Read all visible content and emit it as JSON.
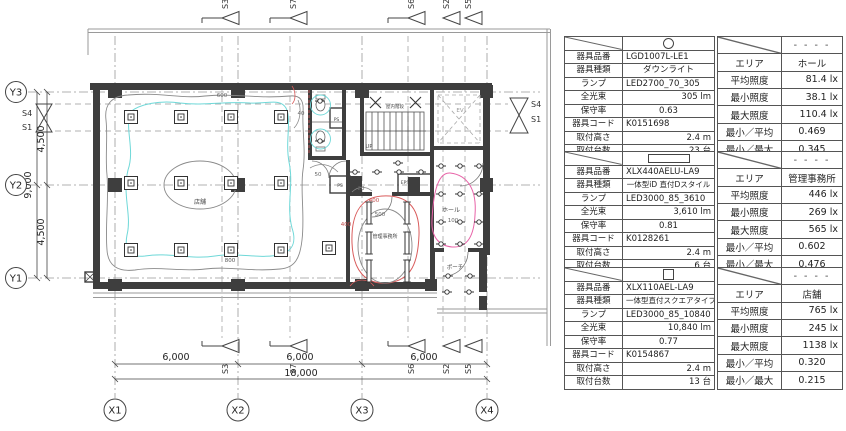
{
  "drawing": {
    "plan": {
      "grid_x_labels": [
        "X1",
        "X2",
        "X3",
        "X4"
      ],
      "grid_y_labels": [
        "Y3",
        "Y2",
        "Y1"
      ],
      "dim_h_segments": [
        "6,000",
        "6,000",
        "6,000"
      ],
      "dim_h_total": "18,000",
      "dim_v_segments": [
        "4,500",
        "4,500"
      ],
      "dim_v_total": "9,000",
      "sections_top": [
        "S3",
        "S7",
        "S6",
        "S2",
        "S5"
      ],
      "sections_bottom": [
        "S3",
        "S7",
        "S6",
        "S2",
        "S5"
      ],
      "sections_left": [
        "S4",
        "S1"
      ],
      "sections_right": [
        "S4",
        "S1"
      ],
      "rooms": {
        "store": "店舗",
        "office": "管理事務所",
        "hall": "ホール",
        "porch": "ポーチ",
        "stairs": "屋内階段",
        "up": "UP",
        "elevator": "EV",
        "ps_toilet": "PS",
        "ps_corridor": "PS",
        "eps": "EPS"
      },
      "isolux_labels": {
        "store_outer": "600",
        "store_inner": "800",
        "office_left": "400",
        "office_top": "400",
        "office_inner": "500",
        "hall": "100",
        "corridor": "50",
        "toilet": "40",
        "office_door": "20"
      },
      "colors": {
        "contour_cyan": "#6fd8d8",
        "contour_red": "#d95b5b",
        "contour_pink": "#e863a8",
        "contour_gray": "#8a8a8a",
        "wall": "#3e3e3e"
      }
    },
    "tables": [
      {
        "fixture": {
          "symbol": "downlight-circle",
          "rows": [
            {
              "label": "器具品番",
              "value": "LGD1007L-LE1"
            },
            {
              "label": "器具種類",
              "value": "ダウンライト"
            },
            {
              "label": "ランプ",
              "value": "LED2700_70_305"
            },
            {
              "label": "全光束",
              "value": "305 lm"
            },
            {
              "label": "保守率",
              "value": "0.63"
            },
            {
              "label": "器具コード",
              "value": "K0151698"
            },
            {
              "label": "取付高さ",
              "value": "2.4 m"
            },
            {
              "label": "取付台数",
              "value": "23 台"
            }
          ]
        },
        "illuminance": {
          "header_value": "- - - -",
          "rows": [
            {
              "label": "エリア",
              "value": "ホール"
            },
            {
              "label": "平均照度",
              "value": "81.4 lx"
            },
            {
              "label": "最小照度",
              "value": "38.1 lx"
            },
            {
              "label": "最大照度",
              "value": "110.4 lx"
            },
            {
              "label": "最小／平均",
              "value": "0.469"
            },
            {
              "label": "最小／最大",
              "value": "0.345"
            }
          ]
        }
      },
      {
        "fixture": {
          "symbol": "linear-bar",
          "rows": [
            {
              "label": "器具品番",
              "value": "XLX440AELU-LA9"
            },
            {
              "label": "器具種類",
              "value": "一体型iD 直付Dスタイル"
            },
            {
              "label": "ランプ",
              "value": "LED3000_85_3610"
            },
            {
              "label": "全光束",
              "value": "3,610 lm"
            },
            {
              "label": "保守率",
              "value": "0.81"
            },
            {
              "label": "器具コード",
              "value": "K0128261"
            },
            {
              "label": "取付高さ",
              "value": "2.4 m"
            },
            {
              "label": "取付台数",
              "value": "6 台"
            }
          ]
        },
        "illuminance": {
          "header_value": "- - - -",
          "rows": [
            {
              "label": "エリア",
              "value": "管理事務所"
            },
            {
              "label": "平均照度",
              "value": "446 lx"
            },
            {
              "label": "最小照度",
              "value": "269 lx"
            },
            {
              "label": "最大照度",
              "value": "565 lx"
            },
            {
              "label": "最小／平均",
              "value": "0.602"
            },
            {
              "label": "最小／最大",
              "value": "0.476"
            }
          ]
        }
      },
      {
        "fixture": {
          "symbol": "square",
          "rows": [
            {
              "label": "器具品番",
              "value": "XLX110AEL-LA9"
            },
            {
              "label": "器具種類",
              "value": "一体型直付スクエアタイプ"
            },
            {
              "label": "ランプ",
              "value": "LED3000_85_10840"
            },
            {
              "label": "全光束",
              "value": "10,840 lm"
            },
            {
              "label": "保守率",
              "value": "0.77"
            },
            {
              "label": "器具コード",
              "value": "K0154867"
            },
            {
              "label": "取付高さ",
              "value": "2.4 m"
            },
            {
              "label": "取付台数",
              "value": "13 台"
            }
          ]
        },
        "illuminance": {
          "header_value": "- - - -",
          "rows": [
            {
              "label": "エリア",
              "value": "店舗"
            },
            {
              "label": "平均照度",
              "value": "765 lx"
            },
            {
              "label": "最小照度",
              "value": "245 lx"
            },
            {
              "label": "最大照度",
              "value": "1138 lx"
            },
            {
              "label": "最小／平均",
              "value": "0.320"
            },
            {
              "label": "最小／最大",
              "value": "0.215"
            }
          ]
        }
      }
    ]
  }
}
